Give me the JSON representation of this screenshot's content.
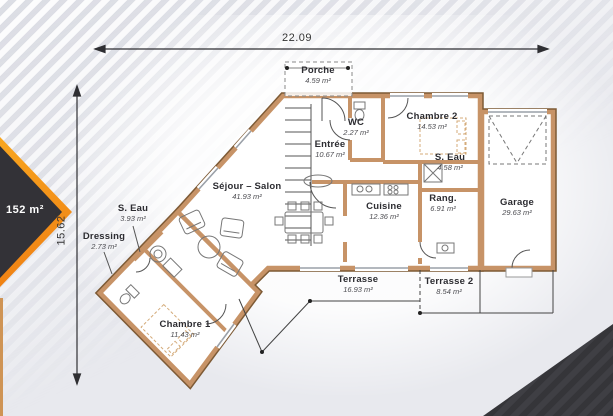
{
  "badge": {
    "area_label": "152 m²"
  },
  "dimensions": {
    "width": "22.09",
    "height": "15.62",
    "height_sup": "5"
  },
  "rooms": {
    "porche": {
      "name": "Porche",
      "area": "4.59 m²"
    },
    "wc": {
      "name": "WC",
      "area": "2.27 m²"
    },
    "entree": {
      "name": "Entrée",
      "area": "10.67 m²"
    },
    "chambre2": {
      "name": "Chambre 2",
      "area": "14.53 m²"
    },
    "s_eau_2": {
      "name": "S. Eau",
      "area": "4.58 m²"
    },
    "rangement": {
      "name": "Rang.",
      "area": "6.91 m²"
    },
    "garage": {
      "name": "Garage",
      "area": "29.63 m²"
    },
    "cuisine": {
      "name": "Cuisine",
      "area": "12.36 m²"
    },
    "sejour": {
      "name": "Séjour – Salon",
      "area": "41.93 m²"
    },
    "s_eau_1": {
      "name": "S. Eau",
      "area": "3.93 m²"
    },
    "dressing": {
      "name": "Dressing",
      "area": "2.73 m²"
    },
    "chambre1": {
      "name": "Chambre 1",
      "area": "11.43 m²"
    },
    "terrasse": {
      "name": "Terrasse",
      "area": "16.93 m²"
    },
    "terrasse2": {
      "name": "Terrasse 2",
      "area": "8.54 m²"
    }
  },
  "colors": {
    "wall_fill": "#c79367",
    "wall_edge": "#7d5a35",
    "accent_orange": "#f5921e",
    "dark_corner": "#3a393d",
    "background": "#e8e9ee",
    "paper": "#ffffff",
    "thin_line": "#555555"
  }
}
